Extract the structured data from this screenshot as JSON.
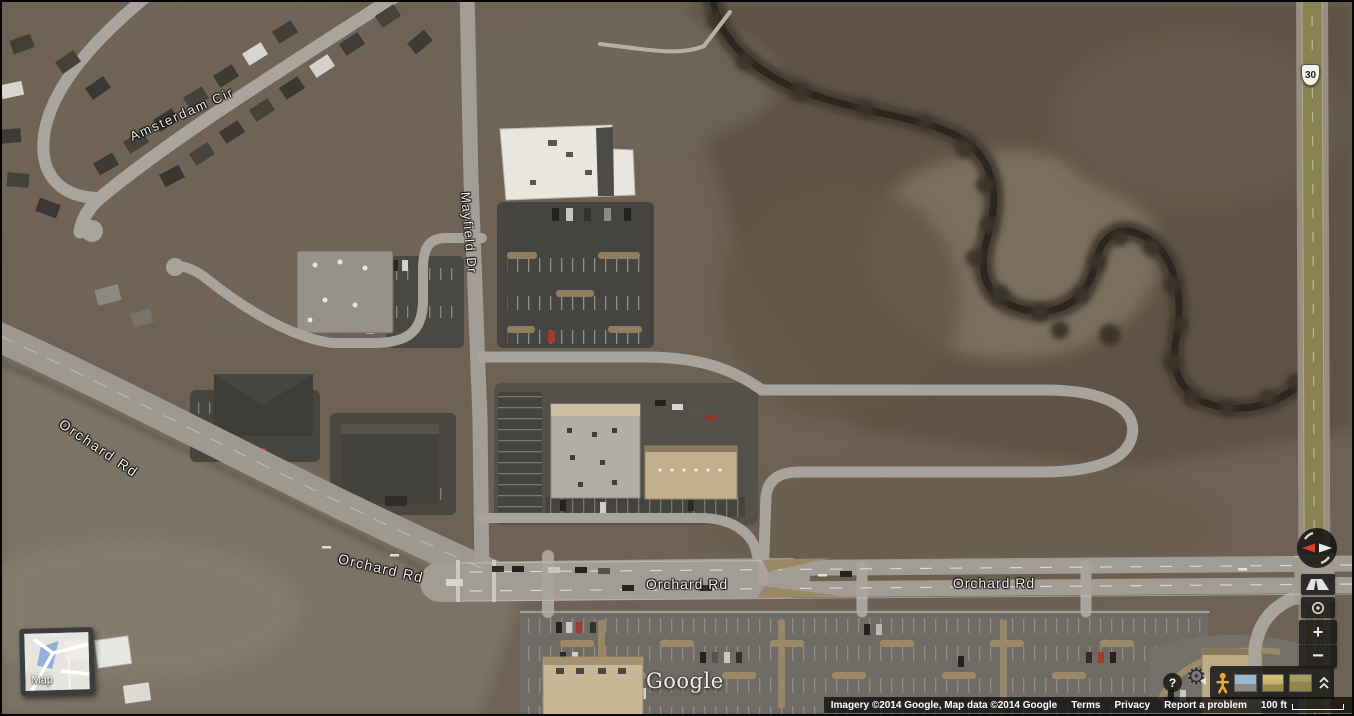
{
  "map": {
    "type": "satellite",
    "labels": {
      "amsterdam_cir": "Amsterdam Cir",
      "mayfield_dr": "Mayfield Dr",
      "orchard_rd_sw": "Orchard Rd",
      "orchard_rd_w": "Orchard Rd",
      "orchard_rd_center": "Orchard Rd",
      "orchard_rd_east": "Orchard Rd",
      "route_shield": "30"
    },
    "watermark": "Google"
  },
  "map_type_toggle": {
    "label": "Map"
  },
  "controls": {
    "help_glyph": "?",
    "settings_glyph": "⚙",
    "zoom_in_glyph": "+",
    "zoom_out_glyph": "−"
  },
  "footer": {
    "attribution": "Imagery ©2014 Google, Map data ©2014 Google",
    "terms": "Terms",
    "privacy": "Privacy",
    "report_a_problem": "Report a problem",
    "scale_label": "100 ft"
  },
  "colors": {
    "control_bg": "#1a1a1a",
    "pegman_orange": "#eda83a",
    "compass_red": "#da3b2a",
    "map_water_blue": "#8fb1dc"
  }
}
